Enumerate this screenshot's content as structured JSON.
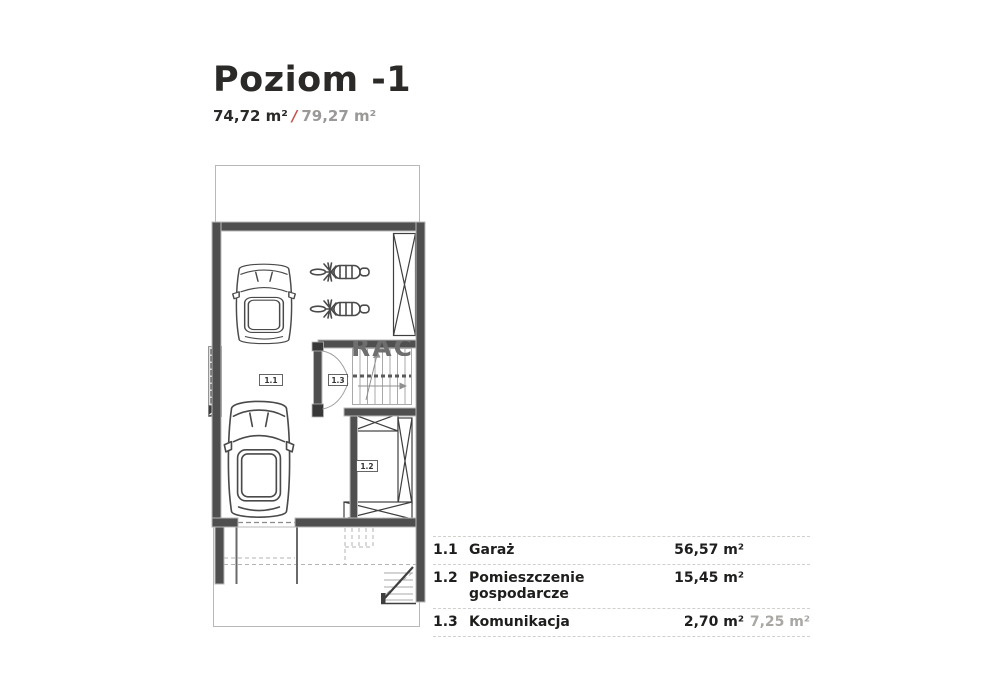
{
  "header": {
    "title": "Poziom -1",
    "area_primary": "74,72 m²",
    "area_separator": "/",
    "area_secondary": "79,27 m²"
  },
  "plan": {
    "room_labels": [
      {
        "id": "1.1"
      },
      {
        "id": "1.3"
      },
      {
        "id": "1.2"
      }
    ],
    "watermark": "RAC",
    "colors": {
      "wall": "#4f4f4f",
      "wall_outline": "#b8b8b8",
      "line": "#3f3f3f",
      "light_line": "#a9a9a9",
      "dashed": "#9a9a9a"
    }
  },
  "legend": {
    "rows": [
      {
        "no": "1.1",
        "name": "Garaż",
        "area": "56,57 m²",
        "area_secondary": ""
      },
      {
        "no": "1.2",
        "name": "Pomieszczenie gospodarcze",
        "area": "15,45 m²",
        "area_secondary": ""
      },
      {
        "no": "1.3",
        "name": "Komunikacja",
        "area": "2,70 m²",
        "area_secondary": "7,25 m²"
      }
    ]
  },
  "colors": {
    "accent_slash": "#c2544a",
    "secondary_text": "#9b9997",
    "title_text": "#2b2a28"
  }
}
